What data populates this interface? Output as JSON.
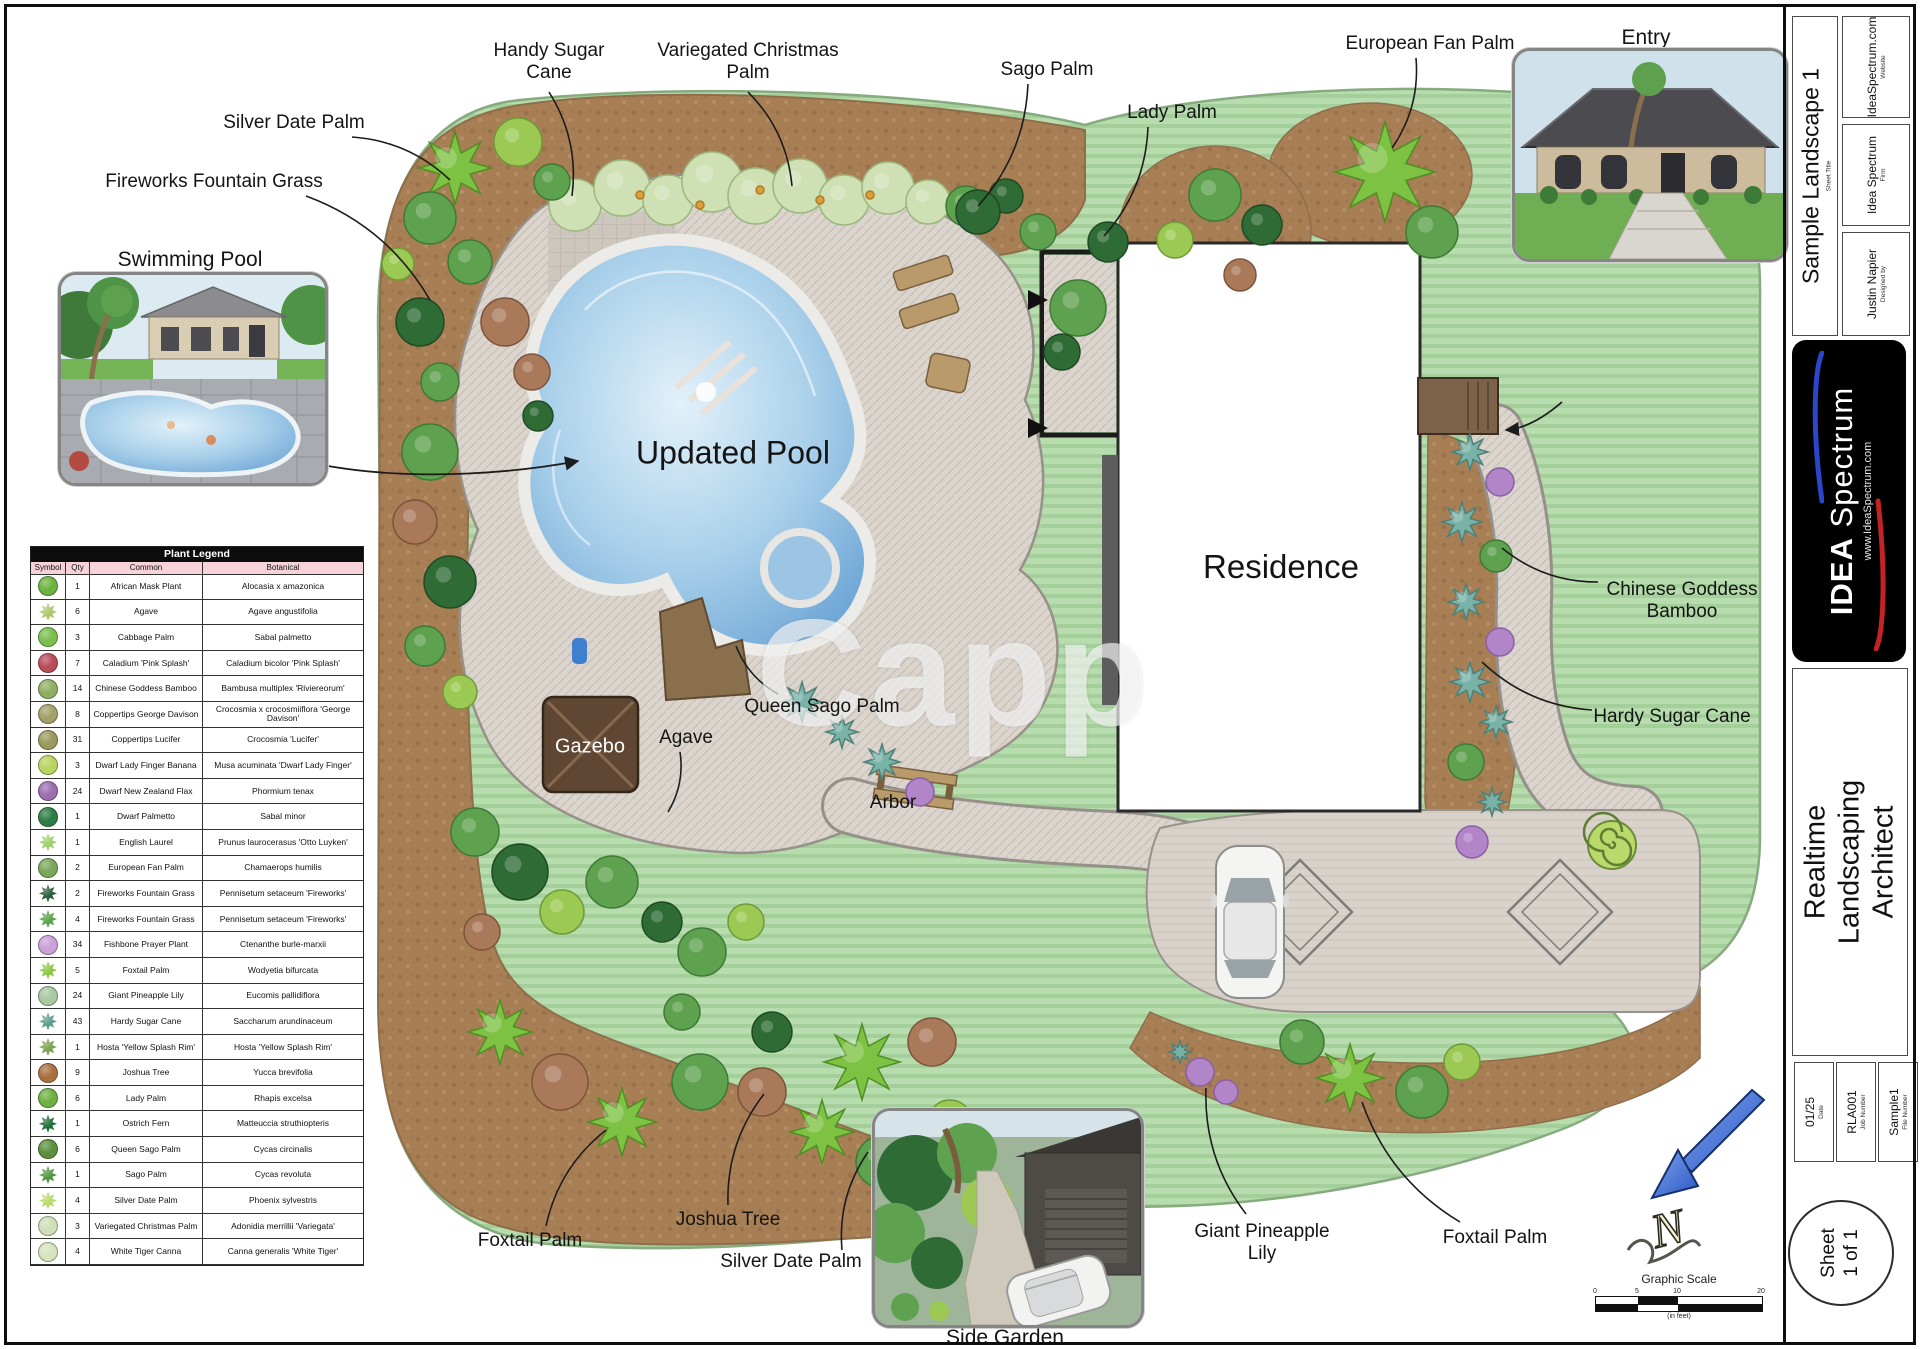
{
  "sheet": {
    "watermark": "Capp"
  },
  "legend": {
    "title": "Plant Legend",
    "columns": [
      "Symbol",
      "Qty",
      "Common",
      "Botanical"
    ],
    "rows": [
      {
        "qty": "1",
        "common": "African Mask Plant",
        "botanical": "Alocasia x amazonica",
        "color": "#6db33f",
        "shape": "round"
      },
      {
        "qty": "6",
        "common": "Agave",
        "botanical": "Agave angustifolia",
        "color": "#a8c66c",
        "shape": "spiky"
      },
      {
        "qty": "3",
        "common": "Cabbage Palm",
        "botanical": "Sabal palmetto",
        "color": "#7bbf4d",
        "shape": "round"
      },
      {
        "qty": "7",
        "common": "Caladium 'Pink Splash'",
        "botanical": "Caladium bicolor 'Pink Splash'",
        "color": "#b84d5a",
        "shape": "round"
      },
      {
        "qty": "14",
        "common": "Chinese Goddess Bamboo",
        "botanical": "Bambusa multiplex 'Riviereorum'",
        "color": "#8fae62",
        "shape": "round"
      },
      {
        "qty": "8",
        "common": "Coppertips George Davison",
        "botanical": "Crocosmia x crocosmiiflora 'George Davison'",
        "color": "#a3a06a",
        "shape": "round"
      },
      {
        "qty": "31",
        "common": "Coppertips Lucifer",
        "botanical": "Crocosmia 'Lucifer'",
        "color": "#9a9a5e",
        "shape": "round"
      },
      {
        "qty": "3",
        "common": "Dwarf Lady Finger Banana",
        "botanical": "Musa acuminata 'Dwarf Lady Finger'",
        "color": "#b6d45e",
        "shape": "round"
      },
      {
        "qty": "24",
        "common": "Dwarf New Zealand Flax",
        "botanical": "Phormium tenax",
        "color": "#9b6fb0",
        "shape": "round"
      },
      {
        "qty": "1",
        "common": "Dwarf Palmetto",
        "botanical": "Sabal minor",
        "color": "#2e7d46",
        "shape": "round"
      },
      {
        "qty": "1",
        "common": "English Laurel",
        "botanical": "Prunus laurocerasus 'Otto Luyken'",
        "color": "#9ccf6a",
        "shape": "spiky"
      },
      {
        "qty": "2",
        "common": "European Fan Palm",
        "botanical": "Chamaerops humilis",
        "color": "#79a85a",
        "shape": "round"
      },
      {
        "qty": "2",
        "common": "Fireworks Fountain Grass",
        "botanical": "Pennisetum setaceum 'Fireworks'",
        "color": "#2f5d3a",
        "shape": "spiky"
      },
      {
        "qty": "4",
        "common": "Fireworks Fountain Grass",
        "botanical": "Pennisetum setaceum 'Fireworks'",
        "color": "#58a04b",
        "shape": "spiky"
      },
      {
        "qty": "34",
        "common": "Fishbone Prayer Plant",
        "botanical": "Ctenanthe burle-marxii",
        "color": "#c9a0d8",
        "shape": "round"
      },
      {
        "qty": "5",
        "common": "Foxtail Palm",
        "botanical": "Wodyetia bifurcata",
        "color": "#8cc63f",
        "shape": "spiky"
      },
      {
        "qty": "24",
        "common": "Giant Pineapple Lily",
        "botanical": "Eucomis pallidiflora",
        "color": "#a8c8a0",
        "shape": "round"
      },
      {
        "qty": "43",
        "common": "Hardy Sugar Cane",
        "botanical": "Saccharum arundinaceum",
        "color": "#5e9e8f",
        "shape": "spiky"
      },
      {
        "qty": "1",
        "common": "Hosta 'Yellow Splash Rim'",
        "botanical": "Hosta 'Yellow Splash Rim'",
        "color": "#7aa34f",
        "shape": "spiky"
      },
      {
        "qty": "9",
        "common": "Joshua Tree",
        "botanical": "Yucca brevifolia",
        "color": "#a9713f",
        "shape": "round"
      },
      {
        "qty": "6",
        "common": "Lady Palm",
        "botanical": "Rhapis excelsa",
        "color": "#6fb043",
        "shape": "round"
      },
      {
        "qty": "1",
        "common": "Ostrich Fern",
        "botanical": "Matteuccia struthiopteris",
        "color": "#1e6b34",
        "shape": "spiky"
      },
      {
        "qty": "6",
        "common": "Queen Sago Palm",
        "botanical": "Cycas circinalis",
        "color": "#5c8f3e",
        "shape": "round"
      },
      {
        "qty": "1",
        "common": "Sago Palm",
        "botanical": "Cycas revoluta",
        "color": "#4f9440",
        "shape": "spiky"
      },
      {
        "qty": "4",
        "common": "Silver Date Palm",
        "botanical": "Phoenix sylvestris",
        "color": "#b9d96a",
        "shape": "spiky"
      },
      {
        "qty": "3",
        "common": "Variegated Christmas Palm",
        "botanical": "Adonidia merrillii 'Variegata'",
        "color": "#cfe0b8",
        "shape": "round"
      },
      {
        "qty": "4",
        "common": "White Tiger Canna",
        "botanical": "Canna generalis 'White Tiger'",
        "color": "#d6e3bd",
        "shape": "round"
      }
    ]
  },
  "plan": {
    "labels": [
      {
        "id": "handy-sugar-cane",
        "text": "Handy Sugar\nCane",
        "x": 549,
        "y": 62,
        "leader": [
          549,
          92,
          572,
          196
        ]
      },
      {
        "id": "variegated-christmas-palm",
        "text": "Variegated Christmas\nPalm",
        "x": 748,
        "y": 62,
        "leader": [
          748,
          92,
          792,
          186
        ]
      },
      {
        "id": "sago-palm",
        "text": "Sago Palm",
        "x": 1047,
        "y": 70,
        "leader": [
          1028,
          84,
          978,
          206
        ]
      },
      {
        "id": "lady-palm",
        "text": "Lady Palm",
        "x": 1172,
        "y": 113,
        "leader": [
          1148,
          127,
          1104,
          236
        ]
      },
      {
        "id": "european-fan-palm",
        "text": "European Fan Palm",
        "x": 1430,
        "y": 44,
        "leader": [
          1416,
          58,
          1392,
          148
        ]
      },
      {
        "id": "silver-date-palm-top",
        "text": "Silver Date Palm",
        "x": 294,
        "y": 123,
        "leader": [
          352,
          137,
          450,
          180
        ]
      },
      {
        "id": "fireworks-fountain-grass",
        "text": "Fireworks Fountain Grass",
        "x": 214,
        "y": 182,
        "leader": [
          306,
          196,
          430,
          300
        ]
      },
      {
        "id": "updated-pool",
        "text": "Updated Pool",
        "x": 733,
        "y": 453,
        "size": 32
      },
      {
        "id": "residence",
        "text": "Residence",
        "x": 1281,
        "y": 567,
        "size": 33
      },
      {
        "id": "chinese-goddess-bamboo",
        "text": "Chinese Goddess\nBamboo",
        "x": 1682,
        "y": 601,
        "leader": [
          1598,
          582,
          1502,
          548
        ]
      },
      {
        "id": "hardy-sugar-cane",
        "text": "Hardy Sugar Cane",
        "x": 1672,
        "y": 717,
        "leader": [
          1592,
          710,
          1482,
          662
        ]
      },
      {
        "id": "queen-sago-palm",
        "text": "Queen Sago Palm",
        "x": 822,
        "y": 707,
        "leader": [
          778,
          694,
          736,
          646
        ]
      },
      {
        "id": "gazebo",
        "text": "Gazebo",
        "x": 590,
        "y": 747,
        "size": 20,
        "color": "#ffffff"
      },
      {
        "id": "agave",
        "text": "Agave",
        "x": 686,
        "y": 738,
        "leader": [
          680,
          752,
          668,
          812
        ]
      },
      {
        "id": "arbor",
        "text": "Arbor",
        "x": 893,
        "y": 803
      },
      {
        "id": "foxtail-palm-left",
        "text": "Foxtail Palm",
        "x": 530,
        "y": 1241,
        "leader": [
          546,
          1226,
          606,
          1130
        ]
      },
      {
        "id": "joshua-tree",
        "text": "Joshua Tree",
        "x": 728,
        "y": 1220,
        "leader": [
          728,
          1205,
          764,
          1094
        ]
      },
      {
        "id": "silver-date-palm-bottom",
        "text": "Silver Date Palm",
        "x": 791,
        "y": 1262,
        "leader": [
          842,
          1250,
          868,
          1152
        ]
      },
      {
        "id": "giant-pineapple-lily",
        "text": "Giant Pineapple\nLily",
        "x": 1262,
        "y": 1243,
        "leader": [
          1246,
          1214,
          1206,
          1088
        ]
      },
      {
        "id": "foxtail-palm-right",
        "text": "Foxtail Palm",
        "x": 1495,
        "y": 1238,
        "leader": [
          1460,
          1222,
          1362,
          1102
        ]
      }
    ]
  },
  "insets": {
    "swimming_pool": {
      "caption": "Swimming Pool"
    },
    "entry": {
      "caption": "Entry"
    },
    "side_garden": {
      "caption": "Side Garden"
    }
  },
  "north_arrow": {
    "letter": "N"
  },
  "scale_bar": {
    "title": "Graphic Scale",
    "units": "(in feet)",
    "ticks": [
      "0",
      "5",
      "10",
      "20"
    ]
  },
  "title_block": {
    "sheet_title": {
      "value": "Sample Landscape 1",
      "label": "Sheet Title"
    },
    "website": {
      "value": "IdeaSpectrum.com",
      "label": "Website"
    },
    "firm": {
      "value": "Idea Spectrum",
      "label": "Firm"
    },
    "designed_by": {
      "value": "Justin Napier",
      "label": "Designed by"
    },
    "logo": {
      "idea": "IDEA",
      "spectrum": " Spectrum",
      "url": "www.IdeaSpectrum.com"
    },
    "product": "Realtime Landscaping\nArchitect",
    "date": {
      "value": "01/25",
      "label": "Date"
    },
    "job_number": {
      "value": "RLA001",
      "label": "Job Number"
    },
    "file_number": {
      "value": "Sample1",
      "label": "File Number"
    },
    "sheet_number": "Sheet\n1 of 1"
  }
}
